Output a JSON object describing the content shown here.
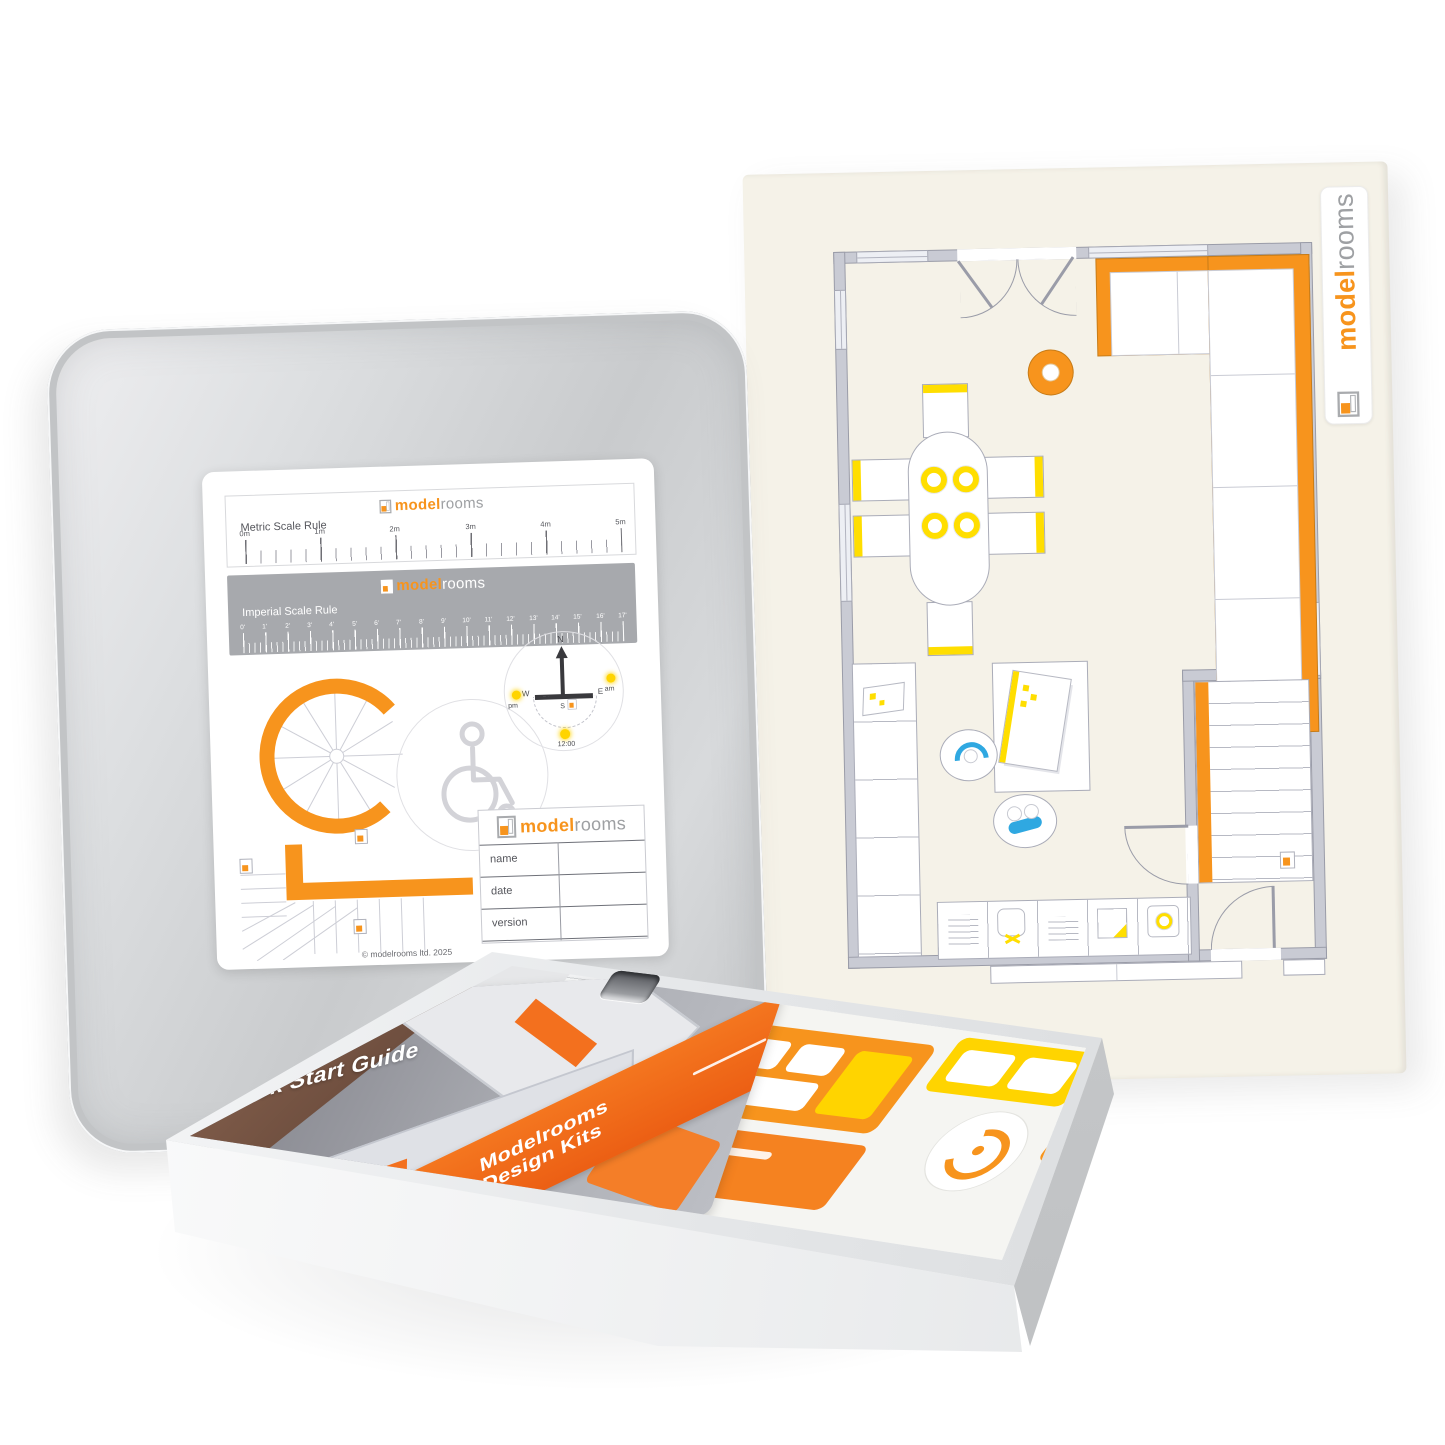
{
  "brand": {
    "model": "model",
    "rooms": "rooms"
  },
  "lid_insert": {
    "metric_rule": {
      "label": "Metric Scale Rule",
      "ticks": [
        "0m",
        "1m",
        "2m",
        "3m",
        "4m",
        "5m"
      ]
    },
    "imperial_rule": {
      "label": "Imperial Scale Rule",
      "ticks": [
        "0'",
        "1'",
        "2'",
        "3'",
        "4'",
        "5'",
        "6'",
        "7'",
        "8'",
        "9'",
        "10'",
        "11'",
        "12'",
        "13'",
        "14'",
        "15'",
        "16'",
        "17'"
      ]
    },
    "compass": {
      "north": "N",
      "east": "E",
      "south": "S",
      "west": "W",
      "am": "am",
      "pm": "pm",
      "noon": "12:00"
    },
    "title_block": {
      "rows": [
        "name",
        "date",
        "version"
      ]
    },
    "copyright": "© modelrooms ltd. 2025"
  },
  "booklet": {
    "title": "Quick Start Guide",
    "band": [
      "Modelrooms",
      "Design Kits"
    ]
  },
  "colors": {
    "brand_orange": "#F7941D",
    "brand_gray": "#9EA0A3",
    "deep_orange": "#F4711F",
    "accent_yellow": "#FFDE00",
    "accent_blue": "#2FA8E1"
  }
}
